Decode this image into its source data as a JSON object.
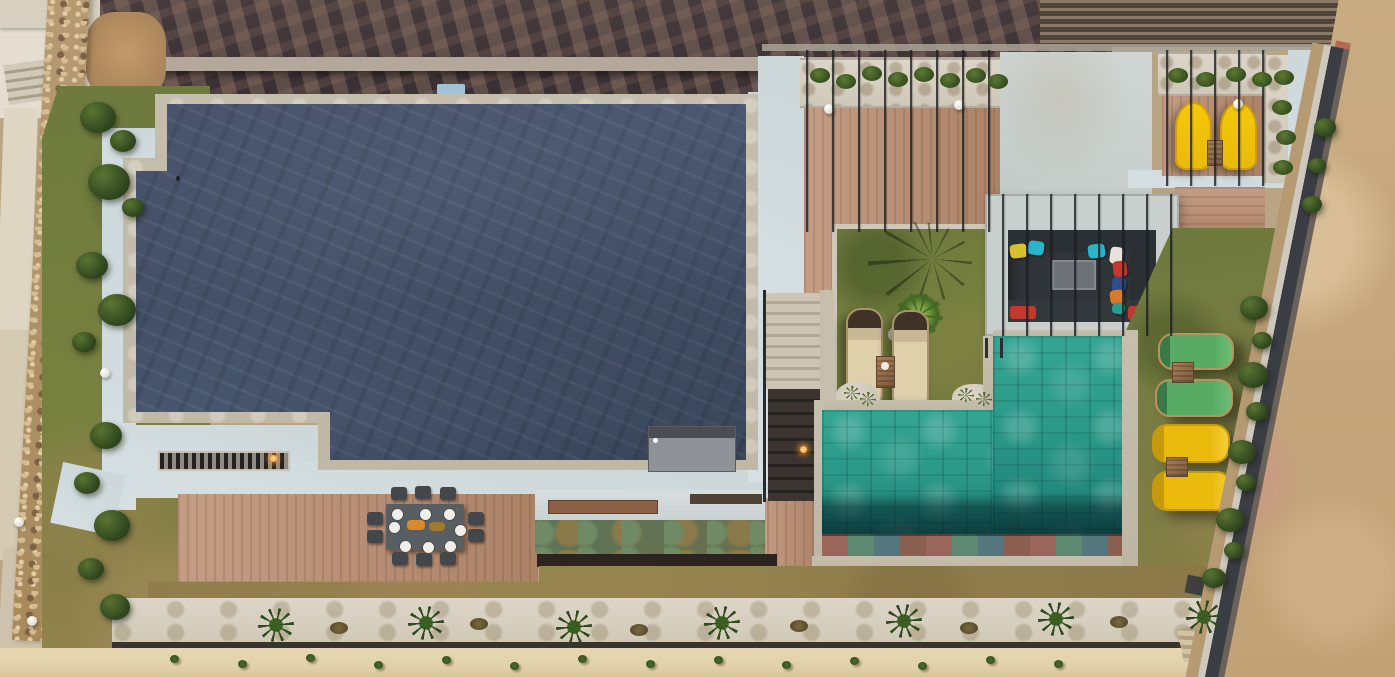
{
  "image": {
    "kind": "aerial drone photograph",
    "subject": "Top-down view of a modern luxury villa: dark slate flat roof with travertine border and pale concrete apron, wooden sun decks, outdoor dining table set for lunch, sunken lounge with colorful pillows, turquoise tiled swimming pool, sun loungers on lawns, landscaped planting beds, stone boundary wall with brick edging and a dirt road",
    "time_of_day": "daytime"
  },
  "palette": {
    "shadow_terrace": "#463a3c",
    "beam": "#b3a89b",
    "roof_slate": "#44506a",
    "travertine": "#c6bfae",
    "concrete_pale": "#ccd7da",
    "concrete_plate": "#cfd6d4",
    "deck_wood": "#c49d85",
    "pool_water": "#2c9a89",
    "pool_deep": "rgba(4,30,36,0.68)",
    "grass_green": "#6e7a3e",
    "grass_dry": "#97854f",
    "dirt_road": "#c2a176",
    "brick_edge": "#b5674f",
    "stone_wall": "#b59a72",
    "gravel_white": "#ddd6c8",
    "bush_green": "#2c431c",
    "lounger_tan": "#ded0ab",
    "lounger_green": "#57ab64",
    "lounger_yellow": "#e9b90c",
    "sofa_dark": "#2b3035",
    "table_dark": "#595e62",
    "plate_white": "#f2efe8",
    "sand_path": "#e2d2ac",
    "walkway_dark": "#39332e",
    "verdigris": "#5a7458",
    "lamp_orange": "#ff9b2d",
    "sky_blue_object": "#9fc3d8",
    "pillow_yellow": "#d8c02f",
    "pillow_cyan": "#2ab5c9",
    "pillow_white": "#e8e4da",
    "pillow_red": "#c3392e",
    "pillow_blue": "#2e4f8c",
    "pillow_orange": "#d97a2a",
    "pillow_teal": "#2a9b8f"
  },
  "objects": {
    "main_roof": "dark slate flat roof with travertine border, pale concrete walkway, vent panel and slatted grate with lit lamp",
    "pool": "turquoise tiled pool, dark deep end, multicolor mosaic tile edge, ladder at top edge",
    "sun_loungers": {
      "tan_round": 2,
      "green": 2,
      "yellow_garden": 2,
      "yellow_pergola": 2
    },
    "dining": {
      "tables": 1,
      "place_settings": 8,
      "chairs": 10,
      "food_platters": 2
    },
    "lounge_pit": {
      "sofas": "dark L-shaped sunken seating under pergola bars",
      "pillow_colors": [
        "pillow_yellow",
        "pillow_cyan",
        "pillow_cyan",
        "pillow_white",
        "pillow_red",
        "pillow_blue",
        "pillow_orange",
        "pillow_teal"
      ],
      "red_cushions": 2
    },
    "palm_trees_in_bed": 7,
    "garden_globe_lights": 3,
    "pergola_globe_lights": 3,
    "planters": 3,
    "side_tables": 5,
    "stairs": "stone steps descending between decks with lit lamp",
    "boundary": "diagonal stone wall with concrete cap, shadow band and red brick edging beside dirt road"
  }
}
